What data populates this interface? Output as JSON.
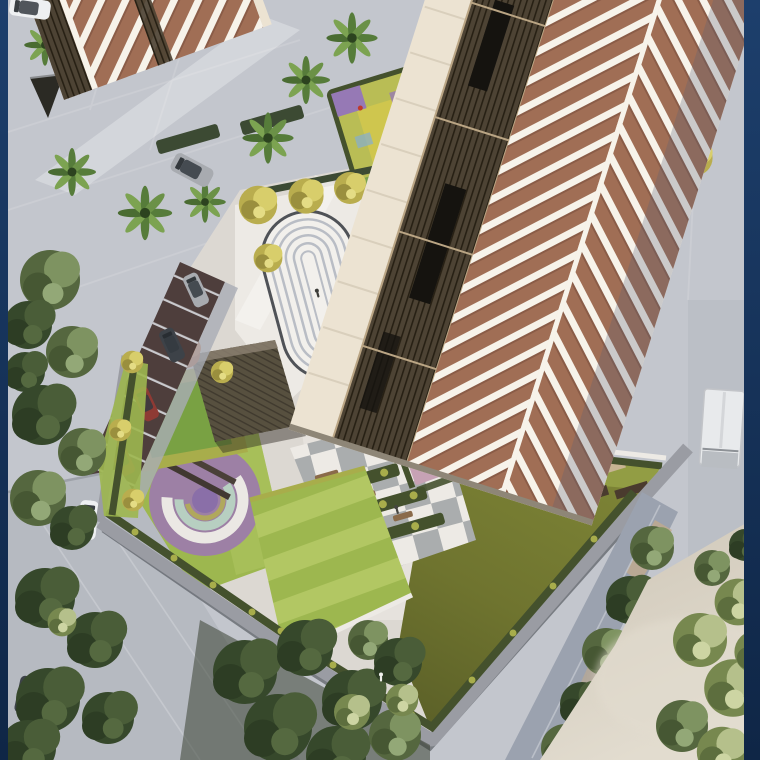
{
  "meta": {
    "type": "natural-image",
    "subject": "aerial top-down 3D architectural render of a residential high-rise complex with landscaped podium amenity deck",
    "width_px": 760,
    "height_px": 760
  },
  "frame": {
    "left_border_px": 8,
    "right_border_px": 16,
    "border_color": "#1d3f6c"
  },
  "palette": {
    "border-navy": "#1d3f6c",
    "border-navy-dark": "#0f2646",
    "street": "#c3c6cd",
    "street-shade": "#b6bac1",
    "street-dark": "#a9adb5",
    "paving": "#dcd8d2",
    "paving-light": "#edeae5",
    "tile-dark": "#aaadae",
    "cream": "#ece3d2",
    "slab-white": "#f7f3ea",
    "terracotta": "#a06e55",
    "terracotta-dark": "#8a5c47",
    "louver": "#4d4334",
    "louver-line": "#272014",
    "louver-frame": "#baa584",
    "court-pink": "#c7a2b5",
    "court-pink-light": "#d4b5c3",
    "court-line": "#f2ecf2",
    "lawn": "#9db74f",
    "lawn-light": "#b2c763",
    "lawn-olive": "#7d8436",
    "lawn-dark": "#5c6128",
    "hedge-dark": "#44512d",
    "hedge-yellow": "#a8ad4b",
    "tree-dark": "#36482b",
    "tree-green": "#55673f",
    "tree-light": "#77884f",
    "tree-yellow": "#b9ad4e",
    "parking": "#4e3e3c",
    "stall-line": "#d8dade",
    "maze-white": "#f2f0ec",
    "maze-ring": "#b9bdc5",
    "maze-outline": "#4f5257",
    "circle-mauve": "#9d80a5",
    "circle-white": "#ebe8e4",
    "circle-teal": "#b7cfc1",
    "circle-purple": "#8a6fa8",
    "circle-yellow": "#b3ac55",
    "play-base": "#b9bd55",
    "play-yellow": "#cfc64e",
    "play-purple": "#9679b5",
    "play-blue": "#85aed2",
    "equip-yellow": "#e2b62f",
    "equip-blue": "#2e6cb3",
    "pergola": "#57503f",
    "pergola-line": "#3a342a",
    "wall-gray": "#9a9ca3",
    "wall-shadow": "#595c63",
    "flower-purple": "#5f4b66",
    "flower-orange": "#b85f38",
    "mist": "#cdc5b6",
    "mist-light": "#e2dccf",
    "road-br": "#9ba2af",
    "road-tan": "#c0aa8d",
    "car-silver": "#a8abb0",
    "car-white": "#eef0f2",
    "car-dark": "#3d4248",
    "car-red": "#8e3a34",
    "walkway-tan": "#c7b493"
  },
  "scene": {
    "setting": "bird's-eye view at dusk/daylight of residential towers over a podium garden",
    "features": [
      "main high-rise tower with white chevron balconies, terracotta infill and dark louvered core",
      "second balcony tower at top-left",
      "pink twin sports courts with white markings and 2 players",
      "oval concentric reflexology maze on white paving",
      "purple concentric amphitheater circle on a lawn",
      "children's playground with yellow, purple and blue soft surface and play equipment",
      "dark timber pergola with orange flowering tree",
      "angled parking bay with cars along tree line",
      "checkerboard paved garden with hedge planters and benches",
      "striped mown lawn",
      "large shadowed lawn with terrace steps",
      "podium boundary wall with hedges meeting in a V corner",
      "misty riverside with trees at bottom-right",
      "dense trees along the left edge and bottom groves",
      "white box van on right street"
    ],
    "vehicle_counts": {
      "parking_bay": 5,
      "streets": 4,
      "van_right_street": 1
    },
    "people_visible": 7
  }
}
